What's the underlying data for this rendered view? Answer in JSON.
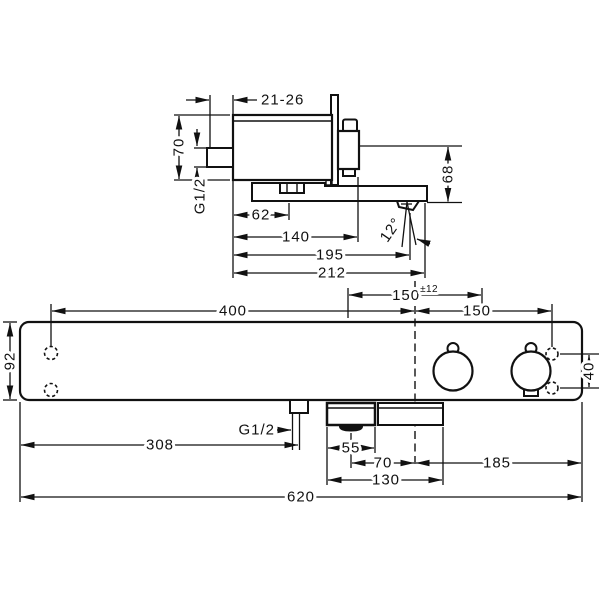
{
  "side_view": {
    "wall_distance": "21-26",
    "body_height": "70",
    "inlet_thread": "G1/2",
    "inlet_offset": "62",
    "handle_depth": "140",
    "spout_depth": "195",
    "total_depth": "212",
    "outlet_height": "68",
    "spout_angle": "12°"
  },
  "front_view": {
    "left_hole_to_center": "400",
    "supply_spacing": "150",
    "supply_tolerance": "±12",
    "center_to_right_hole": "150",
    "body_height": "92",
    "right_hole_spacing": "40",
    "outlet_thread": "G1/2",
    "inlet_position": "308",
    "spout_housing_front": "55",
    "spout_to_center": "70",
    "housing_width": "130",
    "center_to_right_edge": "185",
    "total_width": "620"
  },
  "colors": {
    "line": "#111111",
    "background": "#ffffff"
  }
}
